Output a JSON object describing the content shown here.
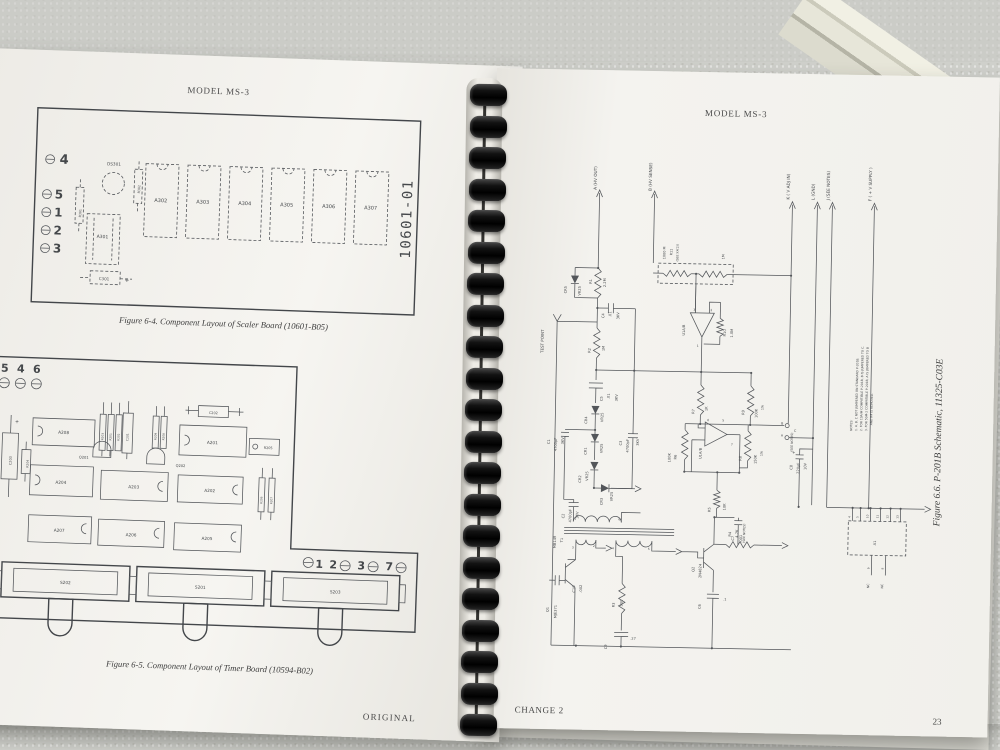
{
  "left_page": {
    "header": "MODEL MS-3",
    "fig64_caption": "Figure 6-4. Component Layout of Scaler Board (10601-B05)",
    "fig65_caption": "Figure 6-5. Component Layout of Timer Board (10594-B02)",
    "page_number": "22",
    "footer": "ORIGINAL",
    "labels": [
      {
        "t": "4",
        "x": 80,
        "y": 113,
        "s": 13,
        "b": 1
      },
      {
        "t": "5",
        "x": 76,
        "y": 148,
        "s": 12,
        "b": 1
      },
      {
        "t": "1",
        "x": 76,
        "y": 166,
        "s": 12,
        "b": 1
      },
      {
        "t": "2",
        "x": 76,
        "y": 184,
        "s": 12,
        "b": 1
      },
      {
        "t": "3",
        "x": 76,
        "y": 202,
        "s": 12,
        "b": 1
      },
      {
        "t": "DS301",
        "x": 130,
        "y": 113,
        "s": 4.2
      },
      {
        "t": "R302",
        "x": 157,
        "y": 140,
        "r": 1,
        "s": 3.2
      },
      {
        "t": "R301",
        "x": 99,
        "y": 166,
        "r": 1,
        "s": 3.2
      },
      {
        "t": "A301",
        "x": 121,
        "y": 186,
        "s": 4.5
      },
      {
        "t": "C301",
        "x": 124,
        "y": 228,
        "s": 4
      },
      {
        "t": "+",
        "x": 147,
        "y": 229,
        "s": 6
      },
      {
        "t": "A302",
        "x": 178,
        "y": 148,
        "s": 5
      },
      {
        "t": "A303",
        "x": 220,
        "y": 148,
        "s": 5
      },
      {
        "t": "A304",
        "x": 262,
        "y": 148,
        "s": 5
      },
      {
        "t": "A305",
        "x": 304,
        "y": 148,
        "s": 5
      },
      {
        "t": "A306",
        "x": 346,
        "y": 148,
        "s": 5
      },
      {
        "t": "A307",
        "x": 388,
        "y": 148,
        "s": 5
      },
      {
        "t": "10601-01",
        "x": 429,
        "y": 196,
        "r": 1,
        "s": 14,
        "m": 1
      },
      {
        "t": "5",
        "x": 28,
        "y": 323,
        "s": 11,
        "b": 1
      },
      {
        "t": "4",
        "x": 44,
        "y": 323,
        "s": 11,
        "b": 1
      },
      {
        "t": "6",
        "x": 60,
        "y": 323,
        "s": 11,
        "b": 1
      },
      {
        "t": "+",
        "x": 42,
        "y": 374,
        "s": 5
      },
      {
        "t": "C203",
        "x": 38,
        "y": 416,
        "r": 1,
        "s": 3.4
      },
      {
        "t": "R204",
        "x": 55,
        "y": 418,
        "r": 1,
        "s": 3
      },
      {
        "t": "A208",
        "x": 89,
        "y": 383,
        "s": 4.2
      },
      {
        "t": "R203",
        "x": 129,
        "y": 388,
        "r": 1,
        "s": 2.8
      },
      {
        "t": "R201",
        "x": 137,
        "y": 388,
        "r": 1,
        "s": 2.8
      },
      {
        "t": "R202",
        "x": 145,
        "y": 388,
        "r": 1,
        "s": 2.8
      },
      {
        "t": "C201",
        "x": 154,
        "y": 388,
        "r": 1,
        "s": 3
      },
      {
        "t": "Q201",
        "x": 110,
        "y": 407,
        "s": 3.6
      },
      {
        "t": "R209",
        "x": 182,
        "y": 386,
        "r": 1,
        "s": 2.8
      },
      {
        "t": "R208",
        "x": 190,
        "y": 386,
        "r": 1,
        "s": 2.8
      },
      {
        "t": "Q202",
        "x": 207,
        "y": 412,
        "s": 3.6
      },
      {
        "t": "C202",
        "x": 238,
        "y": 358,
        "s": 3.4
      },
      {
        "t": "A201",
        "x": 238,
        "y": 388,
        "s": 4.2
      },
      {
        "t": "R205",
        "x": 294,
        "y": 391,
        "s": 3.4
      },
      {
        "t": "A204",
        "x": 88,
        "y": 433,
        "s": 4.2
      },
      {
        "t": "A203",
        "x": 161,
        "y": 435,
        "s": 4.2
      },
      {
        "t": "A202",
        "x": 237,
        "y": 436,
        "s": 4.2
      },
      {
        "t": "R206",
        "x": 290,
        "y": 446,
        "r": 1,
        "s": 2.8
      },
      {
        "t": "R207",
        "x": 300,
        "y": 446,
        "r": 1,
        "s": 2.8
      },
      {
        "t": "A207",
        "x": 88,
        "y": 481,
        "s": 4.2
      },
      {
        "t": "A206",
        "x": 160,
        "y": 483,
        "s": 4.2
      },
      {
        "t": "A205",
        "x": 236,
        "y": 484,
        "s": 4.2
      },
      {
        "t": "1",
        "x": 349,
        "y": 508,
        "s": 11,
        "b": 1
      },
      {
        "t": "2",
        "x": 363,
        "y": 508,
        "s": 11,
        "b": 1
      },
      {
        "t": "3",
        "x": 391,
        "y": 508,
        "s": 11,
        "b": 1
      },
      {
        "t": "7",
        "x": 419,
        "y": 508,
        "s": 11,
        "b": 1
      },
      {
        "t": "S202",
        "x": 96,
        "y": 533,
        "s": 4.2
      },
      {
        "t": "S201",
        "x": 231,
        "y": 533,
        "s": 4.2
      },
      {
        "t": "S203",
        "x": 366,
        "y": 533,
        "s": 4.2
      }
    ]
  },
  "right_page": {
    "header": "MODEL MS-3",
    "caption": "Figure 6.6.  P-201B Schematic, 11325-C03E",
    "footer": "CHANGE 2",
    "page_number": "23",
    "labels": [
      {
        "t": "A  (HV OUT)",
        "x": 102,
        "y": 120,
        "r": 1,
        "s": 4.2
      },
      {
        "t": "B  (HV SENSE)",
        "x": 157,
        "y": 120,
        "r": 1,
        "s": 4.2
      },
      {
        "t": "K  ( V ADJ IN)",
        "x": 295,
        "y": 126,
        "r": 1,
        "s": 4.2
      },
      {
        "t": "L  (GND)",
        "x": 320,
        "y": 126,
        "r": 1,
        "s": 4.2
      },
      {
        "t": "J  (SEE NOTES)",
        "x": 335,
        "y": 126,
        "r": 1,
        "s": 4.2
      },
      {
        "t": "F  ( + V SUPPLY )",
        "x": 377,
        "y": 126,
        "r": 1,
        "s": 4.2
      },
      {
        "t": "TEST POINT",
        "x": 52,
        "y": 284,
        "r": 1,
        "s": 4
      },
      {
        "t": "CR5",
        "x": 74,
        "y": 224,
        "r": 1,
        "s": 3.6
      },
      {
        "t": "VR25",
        "x": 88,
        "y": 226,
        "r": 1,
        "s": 3.6
      },
      {
        "t": "R1",
        "x": 99,
        "y": 214,
        "r": 1,
        "s": 3.6
      },
      {
        "t": "2.2M",
        "x": 113,
        "y": 217,
        "r": 1,
        "s": 3.6
      },
      {
        "t": "1000 M",
        "x": 172,
        "y": 188,
        "r": 1,
        "s": 3.4
      },
      {
        "t": "R11",
        "x": 179,
        "y": 184,
        "r": 1,
        "s": 3.4
      },
      {
        "t": "(SEE XX(2))",
        "x": 185,
        "y": 190,
        "r": 1,
        "s": 3
      },
      {
        "t": "1M",
        "x": 231,
        "y": 187,
        "r": 1,
        "s": 3.4
      },
      {
        "t": "C4",
        "x": 112,
        "y": 248,
        "r": 1,
        "s": 3.6
      },
      {
        "t": ".01",
        "x": 119,
        "y": 247,
        "r": 1,
        "s": 3.6
      },
      {
        "t": "3KV",
        "x": 127,
        "y": 249,
        "r": 1,
        "s": 3.6
      },
      {
        "t": "R2",
        "x": 99,
        "y": 283,
        "r": 1,
        "s": 3.6
      },
      {
        "t": "1M",
        "x": 113,
        "y": 281,
        "r": 1,
        "s": 3.6
      },
      {
        "t": "C5",
        "x": 112,
        "y": 331,
        "r": 1,
        "s": 3.6
      },
      {
        "t": ".01",
        "x": 119,
        "y": 329,
        "r": 1,
        "s": 3.6
      },
      {
        "t": "3KV",
        "x": 127,
        "y": 331,
        "r": 1,
        "s": 3.6
      },
      {
        "t": "CR4",
        "x": 97,
        "y": 354,
        "r": 1,
        "s": 3.6
      },
      {
        "t": "VR25",
        "x": 113,
        "y": 352,
        "r": 1,
        "s": 3.6
      },
      {
        "t": "C1",
        "x": 60,
        "y": 375,
        "r": 1,
        "s": 3.6
      },
      {
        "t": "4700pF",
        "x": 67,
        "y": 382,
        "r": 1,
        "s": 3.6
      },
      {
        "t": "3KV",
        "x": 74,
        "y": 375,
        "r": 1,
        "s": 3.6
      },
      {
        "t": "CR1",
        "x": 97,
        "y": 385,
        "r": 1,
        "s": 3.6
      },
      {
        "t": "VR25",
        "x": 113,
        "y": 383,
        "r": 1,
        "s": 3.6
      },
      {
        "t": "CR2",
        "x": 92,
        "y": 413,
        "r": 1,
        "s": 3.6
      },
      {
        "t": "VR25",
        "x": 99,
        "y": 411,
        "r": 1,
        "s": 3.6
      },
      {
        "t": "C3",
        "x": 132,
        "y": 375,
        "r": 1,
        "s": 3.6
      },
      {
        "t": "4700pF",
        "x": 139,
        "y": 382,
        "r": 1,
        "s": 3.6
      },
      {
        "t": "3KV",
        "x": 149,
        "y": 375,
        "r": 1,
        "s": 3.6
      },
      {
        "t": "CR3",
        "x": 114,
        "y": 435,
        "r": 1,
        "s": 3.6
      },
      {
        "t": "VR25",
        "x": 124,
        "y": 431,
        "r": 1,
        "s": 3.6
      },
      {
        "t": "C2",
        "x": 76,
        "y": 449,
        "r": 1,
        "s": 3.6
      },
      {
        "t": "4700pF",
        "x": 83,
        "y": 453,
        "r": 1,
        "s": 3.6
      },
      {
        "t": "3KV",
        "x": 90,
        "y": 449,
        "r": 1,
        "s": 3.6
      },
      {
        "t": "MB149",
        "x": 68,
        "y": 479,
        "r": 1,
        "s": 3.6
      },
      {
        "t": "T1",
        "x": 75,
        "y": 473,
        "r": 1,
        "s": 3.6
      },
      {
        "t": "1",
        "x": 87,
        "y": 450,
        "s": 3
      },
      {
        "t": "6",
        "x": 131,
        "y": 450,
        "s": 3
      },
      {
        "t": "3",
        "x": 85,
        "y": 479,
        "s": 3
      },
      {
        "t": "2",
        "x": 106,
        "y": 477,
        "s": 3
      },
      {
        "t": "4",
        "x": 125,
        "y": 479,
        "s": 3
      },
      {
        "t": "5",
        "x": 161,
        "y": 479,
        "s": 3
      },
      {
        "t": "Q1",
        "x": 62,
        "y": 543,
        "r": 1,
        "s": 3.6
      },
      {
        "t": "MJE371",
        "x": 70,
        "y": 549,
        "r": 1,
        "s": 3.6
      },
      {
        "t": "C10",
        "x": 88,
        "y": 523,
        "r": 1,
        "s": 3.6
      },
      {
        "t": ".002",
        "x": 95,
        "y": 523,
        "r": 1,
        "s": 3.6
      },
      {
        "t": "R3",
        "x": 128,
        "y": 537,
        "r": 1,
        "s": 3.6
      },
      {
        "t": "500",
        "x": 136,
        "y": 536,
        "r": 1,
        "s": 3.6
      },
      {
        "t": "C9",
        "x": 121,
        "y": 579,
        "r": 1,
        "s": 3.6
      },
      {
        "t": ".27",
        "x": 147,
        "y": 569,
        "s": 3.4
      },
      {
        "t": "Q2",
        "x": 207,
        "y": 500,
        "r": 1,
        "s": 3.6
      },
      {
        "t": "2N4824",
        "x": 214,
        "y": 506,
        "r": 1,
        "s": 3.6
      },
      {
        "t": "R4",
        "x": 243,
        "y": 464,
        "r": 1,
        "s": 3.6
      },
      {
        "t": "4.7K",
        "x": 250,
        "y": 465,
        "r": 1,
        "s": 3.6
      },
      {
        "t": "(SEE NOTES)",
        "x": 257,
        "y": 470,
        "r": 1,
        "s": 3
      },
      {
        "t": "C6",
        "x": 214,
        "y": 537,
        "r": 1,
        "s": 3.6
      },
      {
        "t": ".1",
        "x": 238,
        "y": 528,
        "s": 3.4
      },
      {
        "t": "U1A/B",
        "x": 193,
        "y": 264,
        "r": 1,
        "s": 3.6
      },
      {
        "t": "3",
        "x": 202,
        "y": 239,
        "s": 3
      },
      {
        "t": "2",
        "x": 219,
        "y": 239,
        "s": 3
      },
      {
        "t": "1",
        "x": 206,
        "y": 275,
        "s": 3
      },
      {
        "t": "R10",
        "x": 234,
        "y": 264,
        "r": 1,
        "s": 3.6
      },
      {
        "t": "1.0M",
        "x": 241,
        "y": 265,
        "r": 1,
        "s": 3.6
      },
      {
        "t": "R7",
        "x": 204,
        "y": 342,
        "r": 1,
        "s": 3.6
      },
      {
        "t": "1K",
        "x": 217,
        "y": 339,
        "r": 1,
        "s": 3.6
      },
      {
        "t": "R9",
        "x": 254,
        "y": 342,
        "r": 1,
        "s": 3.6
      },
      {
        "t": "100K",
        "x": 267,
        "y": 345,
        "r": 1,
        "s": 3.6
      },
      {
        "t": "1%",
        "x": 273,
        "y": 337,
        "r": 1,
        "s": 3.3
      },
      {
        "t": "R6",
        "x": 187,
        "y": 388,
        "r": 1,
        "s": 3.6
      },
      {
        "t": "100K",
        "x": 181,
        "y": 391,
        "r": 1,
        "s": 3.6
      },
      {
        "t": "U1A/B",
        "x": 212,
        "y": 387,
        "r": 1,
        "s": 3.6
      },
      {
        "t": "6",
        "x": 218,
        "y": 349,
        "s": 3
      },
      {
        "t": "5",
        "x": 233,
        "y": 349,
        "s": 3
      },
      {
        "t": "7",
        "x": 242,
        "y": 373,
        "s": 3
      },
      {
        "t": "R8",
        "x": 252,
        "y": 388,
        "r": 1,
        "s": 3.6
      },
      {
        "t": "150K",
        "x": 267,
        "y": 391,
        "r": 1,
        "s": 3.6
      },
      {
        "t": "1%",
        "x": 273,
        "y": 383,
        "r": 1,
        "s": 3.3
      },
      {
        "t": "R5",
        "x": 222,
        "y": 440,
        "r": 1,
        "s": 3.6
      },
      {
        "t": "10K",
        "x": 237,
        "y": 438,
        "r": 1,
        "s": 3.6
      },
      {
        "t": "C7",
        "x": 246,
        "y": 468,
        "r": 1,
        "s": 3.6
      },
      {
        "t": ".001",
        "x": 254,
        "y": 470,
        "r": 1,
        "s": 3.6
      },
      {
        "t": "B",
        "x": 292,
        "y": 351,
        "s": 3.2
      },
      {
        "t": "A",
        "x": 292,
        "y": 363,
        "s": 3.2
      },
      {
        "t": "C",
        "x": 305,
        "y": 358,
        "s": 3.2
      },
      {
        "t": "(SEE NOTES)",
        "x": 303,
        "y": 378,
        "r": 1,
        "s": 3
      },
      {
        "t": "C8",
        "x": 303,
        "y": 396,
        "r": 1,
        "s": 3.6
      },
      {
        "t": "220µF",
        "x": 310,
        "y": 400,
        "r": 1,
        "s": 3.6
      },
      {
        "t": "10V",
        "x": 317,
        "y": 396,
        "r": 1,
        "s": 3.6
      },
      {
        "t": "+",
        "x": 304,
        "y": 380,
        "s": 4
      },
      {
        "t": "A1",
        "x": 388,
        "y": 470,
        "r": 1,
        "s": 3.6
      },
      {
        "t": "4",
        "x": 362,
        "y": 443,
        "r": 1,
        "s": 2.8
      },
      {
        "t": "5",
        "x": 370,
        "y": 443,
        "r": 1,
        "s": 2.8
      },
      {
        "t": "10",
        "x": 380,
        "y": 443,
        "r": 1,
        "s": 2.8
      },
      {
        "t": "11",
        "x": 390,
        "y": 443,
        "r": 1,
        "s": 2.8
      },
      {
        "t": "12",
        "x": 400,
        "y": 443,
        "r": 1,
        "s": 2.8
      },
      {
        "t": "13",
        "x": 410,
        "y": 443,
        "r": 1,
        "s": 2.8
      },
      {
        "t": "9",
        "x": 382,
        "y": 494,
        "r": 1,
        "s": 2.8
      },
      {
        "t": "8",
        "x": 396,
        "y": 494,
        "r": 1,
        "s": 2.8
      },
      {
        "t": "NC",
        "x": 382,
        "y": 513,
        "r": 1,
        "s": 3.2
      },
      {
        "t": "NC",
        "x": 396,
        "y": 513,
        "r": 1,
        "s": 3.2
      },
      {
        "t": "NOTES:",
        "x": 362,
        "y": 356,
        "r": 1,
        "s": 3
      },
      {
        "t": "1. A, B, C NOT JUMPERED ON STANDARD P-201B.",
        "x": 367,
        "y": 356,
        "r": 1,
        "s": 3
      },
      {
        "t": "2. FOR 10A/M COMPATIBLE P-201B, B IS JUMPERED TO C.",
        "x": 372,
        "y": 356,
        "r": 1,
        "s": 3
      },
      {
        "t": "3. FOR 50M-2 COMPATIBLE P-201B, A IS JUMPERED TO B",
        "x": 377,
        "y": 356,
        "r": 1,
        "s": 3
      },
      {
        "t": "AND R4 IS REMOVED.",
        "x": 382,
        "y": 350,
        "r": 1,
        "s": 3
      }
    ]
  }
}
